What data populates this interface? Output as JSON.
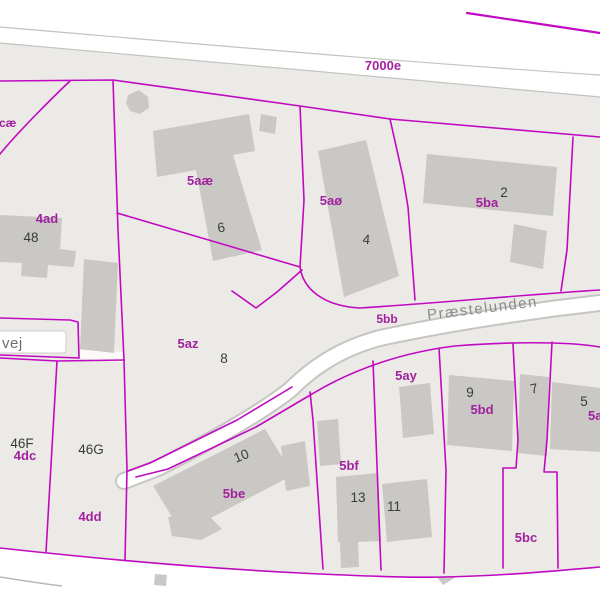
{
  "map": {
    "type": "cadastral-parcel-map",
    "colors": {
      "background": "#ffffff",
      "parcel_fill": "#ebeae6",
      "boundary_magenta": "#c109c1",
      "parcel_label_magenta": "#a2219e",
      "building_fill": "#c9c8c5",
      "road_casing_gray": "#c6c5c2",
      "house_number": "#3a3a3a",
      "street_label_gray": "#8a8a8a"
    },
    "roads": {
      "top_road": "7000e",
      "street": "Præstelunden",
      "street_parcel": "5bb",
      "left_street": "vej"
    },
    "parcel_labels": [
      {
        "label": "cæ"
      },
      {
        "label": "4ad"
      },
      {
        "label": "5aæ"
      },
      {
        "label": "5aø"
      },
      {
        "label": "5ba"
      },
      {
        "label": "5az"
      },
      {
        "label": "4dc"
      },
      {
        "label": "4dd"
      },
      {
        "label": "5be"
      },
      {
        "label": "5bf"
      },
      {
        "label": "5ay"
      },
      {
        "label": "5bd"
      },
      {
        "label": "5an"
      },
      {
        "label": "5bc"
      }
    ],
    "house_numbers": [
      {
        "label": "48"
      },
      {
        "label": "46F"
      },
      {
        "label": "46G"
      },
      {
        "label": "6"
      },
      {
        "label": "4"
      },
      {
        "label": "2"
      },
      {
        "label": "8"
      },
      {
        "label": "10"
      },
      {
        "label": "13"
      },
      {
        "label": "11"
      },
      {
        "label": "9"
      },
      {
        "label": "7"
      },
      {
        "label": "5"
      }
    ]
  }
}
